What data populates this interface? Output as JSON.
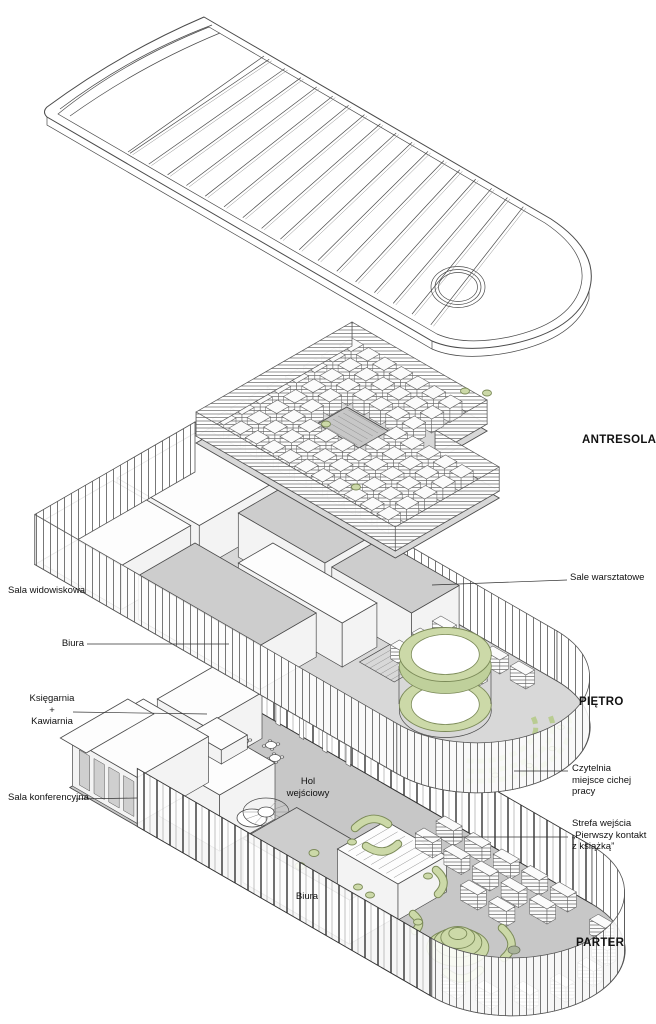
{
  "document": {
    "type": "architectural-exploded-axonometric",
    "subject": "library building - exploded floor plans",
    "language": "pl"
  },
  "levels": [
    {
      "id": "antresola",
      "name": "ANTRESOLA"
    },
    {
      "id": "pietro",
      "name": "PIĘTRO"
    },
    {
      "id": "parter",
      "name": "PARTER"
    }
  ],
  "labels": {
    "sala_widowiskowa": "Sala widowiskowa",
    "biura_pietro": "Biura",
    "ksiegarnia_kawiarnia": "Księgarnia\n+\nKawiarnia",
    "sala_konferencyjna": "Sala konferencyjna",
    "sale_warsztatowe": "Sale warsztatowe",
    "czytelnia": "Czytelnia\nmiejsce cichej pracy",
    "strefa_wejscia": "Strefa wejścia\n„Pierwszy kontakt\nz książką”",
    "hol_wejsciowy": "Hol\nwejściowy",
    "biura_parter": "Biura"
  },
  "colors": {
    "background": "#ffffff",
    "line": "#4a4a4a",
    "floor_gray": "#c7c7c7",
    "floor_light": "#d8d8d8",
    "accent_green": "#ccd9a8",
    "accent_green_dark": "#7b8a58"
  }
}
